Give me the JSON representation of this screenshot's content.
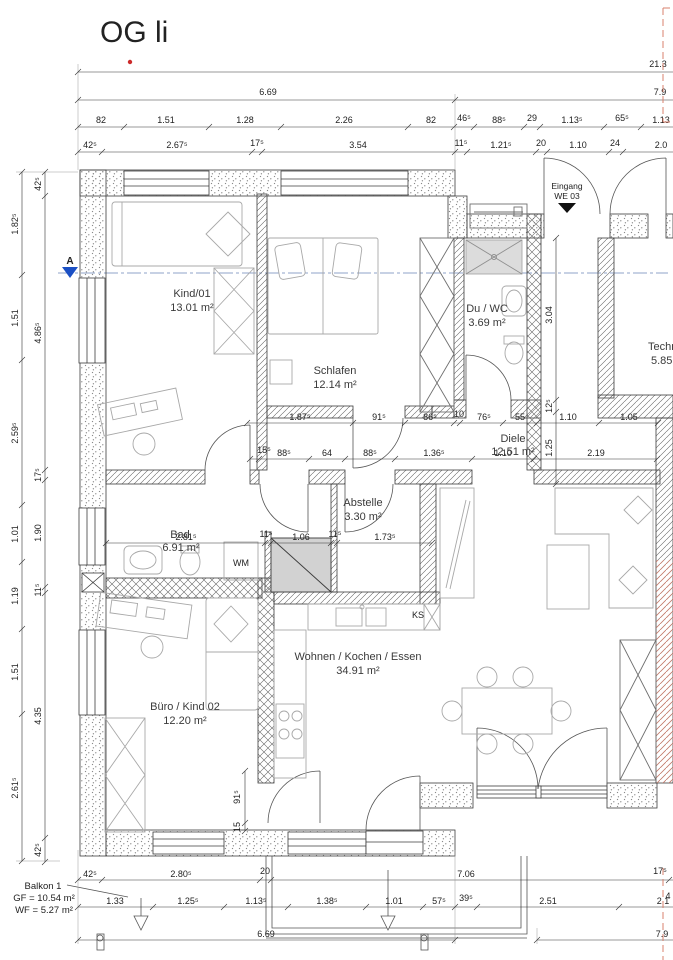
{
  "title": "OG li",
  "entrance": {
    "line1": "Eingang",
    "line2": "WE 03"
  },
  "section": {
    "label": "A"
  },
  "rooms": {
    "kind01": {
      "name": "Kind/01",
      "area": "13.01 m²"
    },
    "schlafen": {
      "name": "Schlafen",
      "area": "12.14 m²"
    },
    "duwc": {
      "name": "Du / WC",
      "area": "3.69 m²"
    },
    "technik": {
      "name": "Techn",
      "area": "5.85"
    },
    "diele": {
      "name": "Diele",
      "area": "12.51 m²"
    },
    "abstelle": {
      "name": "Abstelle",
      "area": "3.30 m²"
    },
    "bad": {
      "name": "Bad",
      "area": "6.91 m²"
    },
    "buero": {
      "name": "Büro / Kind 02",
      "area": "12.20 m²"
    },
    "wohnen": {
      "name": "Wohnen / Kochen / Essen",
      "area": "34.91 m²"
    }
  },
  "labels": {
    "wm": "WM",
    "ks": "KS"
  },
  "balkon": {
    "name": "Balkon 1",
    "gf": "GF = 10.54 m²",
    "wf": "WF = 5.27 m²"
  },
  "dims": {
    "top": {
      "total": "21.3",
      "r2": [
        "6.69",
        "7.9"
      ],
      "r3": [
        "82",
        "1.51",
        "1.28",
        "2.26",
        "82",
        "46⁵",
        "88⁵",
        "29",
        "1.13⁵",
        "65⁵",
        "1.13"
      ],
      "r4": [
        "42⁵",
        "2.67⁵",
        "17⁵",
        "3.54",
        "11⁵",
        "1.21⁵",
        "20",
        "1.10",
        "24",
        "2.0"
      ]
    },
    "left": {
      "outer": [
        "1.82⁵",
        "1.51",
        "2.59⁵",
        "1.01",
        "1.19",
        "1.51",
        "2.61⁵"
      ],
      "inner": [
        "42⁵",
        "4.86⁵",
        "17⁵",
        "1.90",
        "11⁵",
        "4.35",
        "42⁵"
      ]
    },
    "mid": {
      "ra": [
        "1.87⁵",
        "91⁵",
        "86⁵",
        "10",
        "76⁵",
        "55",
        "1.10",
        "1.05"
      ],
      "rb": [
        "15⁵",
        "88⁵",
        "64",
        "88⁵",
        "1.36⁵",
        "1.10",
        "2.19"
      ],
      "rc": [
        "2.81⁵",
        "11⁵",
        "1.06",
        "11⁵",
        "1.73⁵"
      ],
      "v1": "3.04",
      "v2": "12⁵",
      "v3": "1.25",
      "v4": "91⁵",
      "v5": "15"
    },
    "bottom": {
      "r1": [
        "42⁵",
        "2.80⁵",
        "20",
        "7.06",
        "17⁵"
      ],
      "r2": [
        "1.33",
        "1.25⁵",
        "1.13⁵",
        "1.38⁵",
        "1.01",
        "57⁵",
        "39⁵",
        "2.51",
        "2.1"
      ],
      "r3": [
        "6.69",
        "7.9"
      ],
      "frag": "4"
    }
  },
  "colors": {
    "title_blue": "#1565c0",
    "section_blue": "#1a4fc4",
    "red": "#cc2a2a",
    "red_dash": "#d9806c",
    "wall_line": "#3c3c3c",
    "furniture": "#a8a8a8"
  }
}
